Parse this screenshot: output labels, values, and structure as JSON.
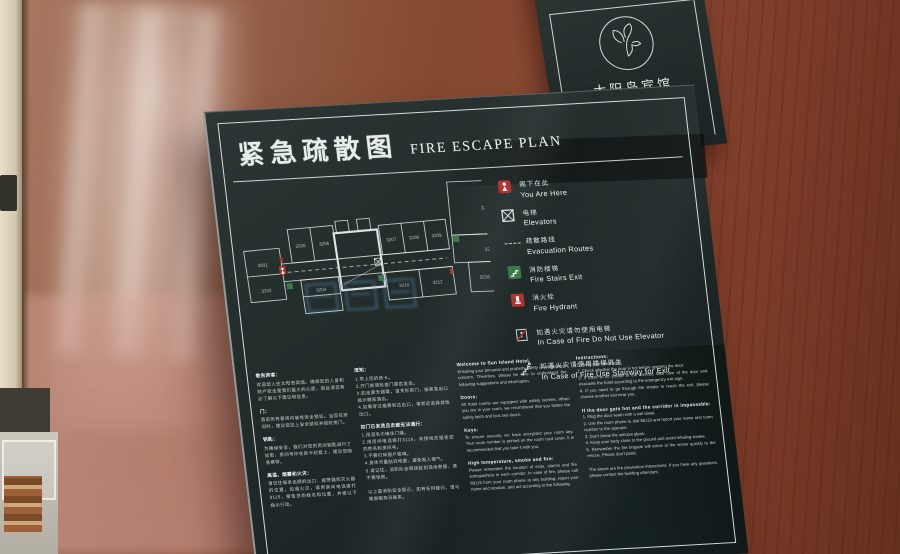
{
  "hotel": {
    "name_cn": "太阳岛宾馆",
    "name_en": "SUN ISLAND HOTEL"
  },
  "colors": {
    "panel": "#1f2928",
    "frame": "#e9efed",
    "red": "#b13430",
    "green": "#3c7a4c",
    "watermark_blue": "#73afe8"
  },
  "sign": {
    "title_cn": "紧急疏散图",
    "title_en": "FIRE ESCAPE PLAN",
    "legend": [
      {
        "cn": "阁下在此",
        "en": "You Are Here"
      },
      {
        "cn": "电梯",
        "en": "Elevators"
      },
      {
        "cn": "疏散路线",
        "en": "Evacuation Routes"
      },
      {
        "cn": "消防楼梯",
        "en": "Fire Stairs Exit"
      },
      {
        "cn": "消火栓",
        "en": "Fire Hydrant"
      },
      {
        "cn": "如遇火灾请勿使用电梯",
        "en": "In Case of Fire Do Not Use Elevator"
      },
      {
        "cn": "如遇火灾请使用楼梯逃生",
        "en": "In Case of Fire Use Stairway for Exit"
      }
    ],
    "plan": {
      "rooms": [
        "3201",
        "3202",
        "3203",
        "3205",
        "3206",
        "3207",
        "3208",
        "3209",
        "3210",
        "3212",
        "3213",
        "3215",
        "3216",
        "3217",
        "3218"
      ]
    },
    "info": {
      "cn1": [
        {
          "h": "敬告宾客：",
          "t": "欢迎您入住太阳岛宾馆。确保您的人身和财产安全是我们最大的心愿，因此请您务必了解以下建议和信息。"
        },
        {
          "h": "门：",
          "t": "酒店所有客房均装有安全锁扣。当您在房间时，建议您扣上安全锁扣并锁好房门。"
        },
        {
          "h": "钥匙：",
          "t": "为确保安全，我们对您的房间钥匙进行了加密，房间号印在房卡封套上，建议您随身携带。"
        },
        {
          "h": "高温、烟雾和火灾：",
          "t": "请记住每条走廊的出口、报警器和灭火器的位置。如遇火灾，请用房间电话拨打8119，报告您的姓名和位置，并按以下指示行动。"
        }
      ],
      "cn2": [
        {
          "h": "须知：",
          "t": "1.带上您的房卡。\n2.开门前请检查门是否发烫。\n3.如走廊无烟雾，请关好房门，按紧急出口指示撤离酒店。\n4.如需穿过烟雾到达出口，请就近选择其他出口。"
        },
        {
          "h": "如门已发烫且走廊无法通行：",
          "t": "1.用湿毛巾堵住门缝。\n2.用房间电话拨打8119，向接线员报告您的姓名和房间号。\n3.不要打碎窗户玻璃。\n4.身体尽量贴近地面，避免吸入烟气。\n5.请记住，消防队会很快赶到现场救援，请不要惊慌。"
        },
        {
          "h": "",
          "t": "以上是消防安全提示，如有任何疑问，请与楼层服务员联系。"
        }
      ],
      "en1": [
        {
          "h": "Welcome to Sun Island Hotel.",
          "t": "Ensuring your personal and property safety is our greatest concern. Therefore, please be sure to understand the following suggestions and information."
        },
        {
          "h": "Doors:",
          "t": "All hotel rooms are equipped with safety latches. When you are in your room, we recommend that you fasten the safety latch and lock two doors."
        },
        {
          "h": "Keys:",
          "t": "To ensure security, we have encrypted your room key. Your room number is printed on the room card cover. It is recommended that you take it with you."
        },
        {
          "h": "High temperature, smoke and fire:",
          "t": "Please remember the location of exits, alarms and fire extinguishers in each corridor. In case of fire, please call 88119 from your room phone at any building, report your name and location, and act according to the following."
        }
      ],
      "en2": [
        {
          "h": "Instructions:",
          "t": "1. Bring your room card.\n2. Check whether the door is hot before opening the door.\n3. If there is no smoke in the corridor, take care of the door and evacuate the hotel according to the emergency exit sign.\n4. If you need to go through the smoke to reach the exit, please choose another exit near you."
        },
        {
          "h": "If the door gets hot and the corridor is impassable:",
          "t": "1. Plug the door seam with a wet towel.\n2. Use the room phone to dial 88119 and report your name and room number to the operator.\n3. Don't break the window glass.\n4. Keep your body close to the ground and avoid inhaling smoke.\n5. Remember the fire brigade will arrive at the scene quickly to the rescue. Please don't panic."
        },
        {
          "h": "",
          "t": "The above are fire prevention instructions. If you have any questions, please contact the building attendant."
        }
      ]
    }
  }
}
